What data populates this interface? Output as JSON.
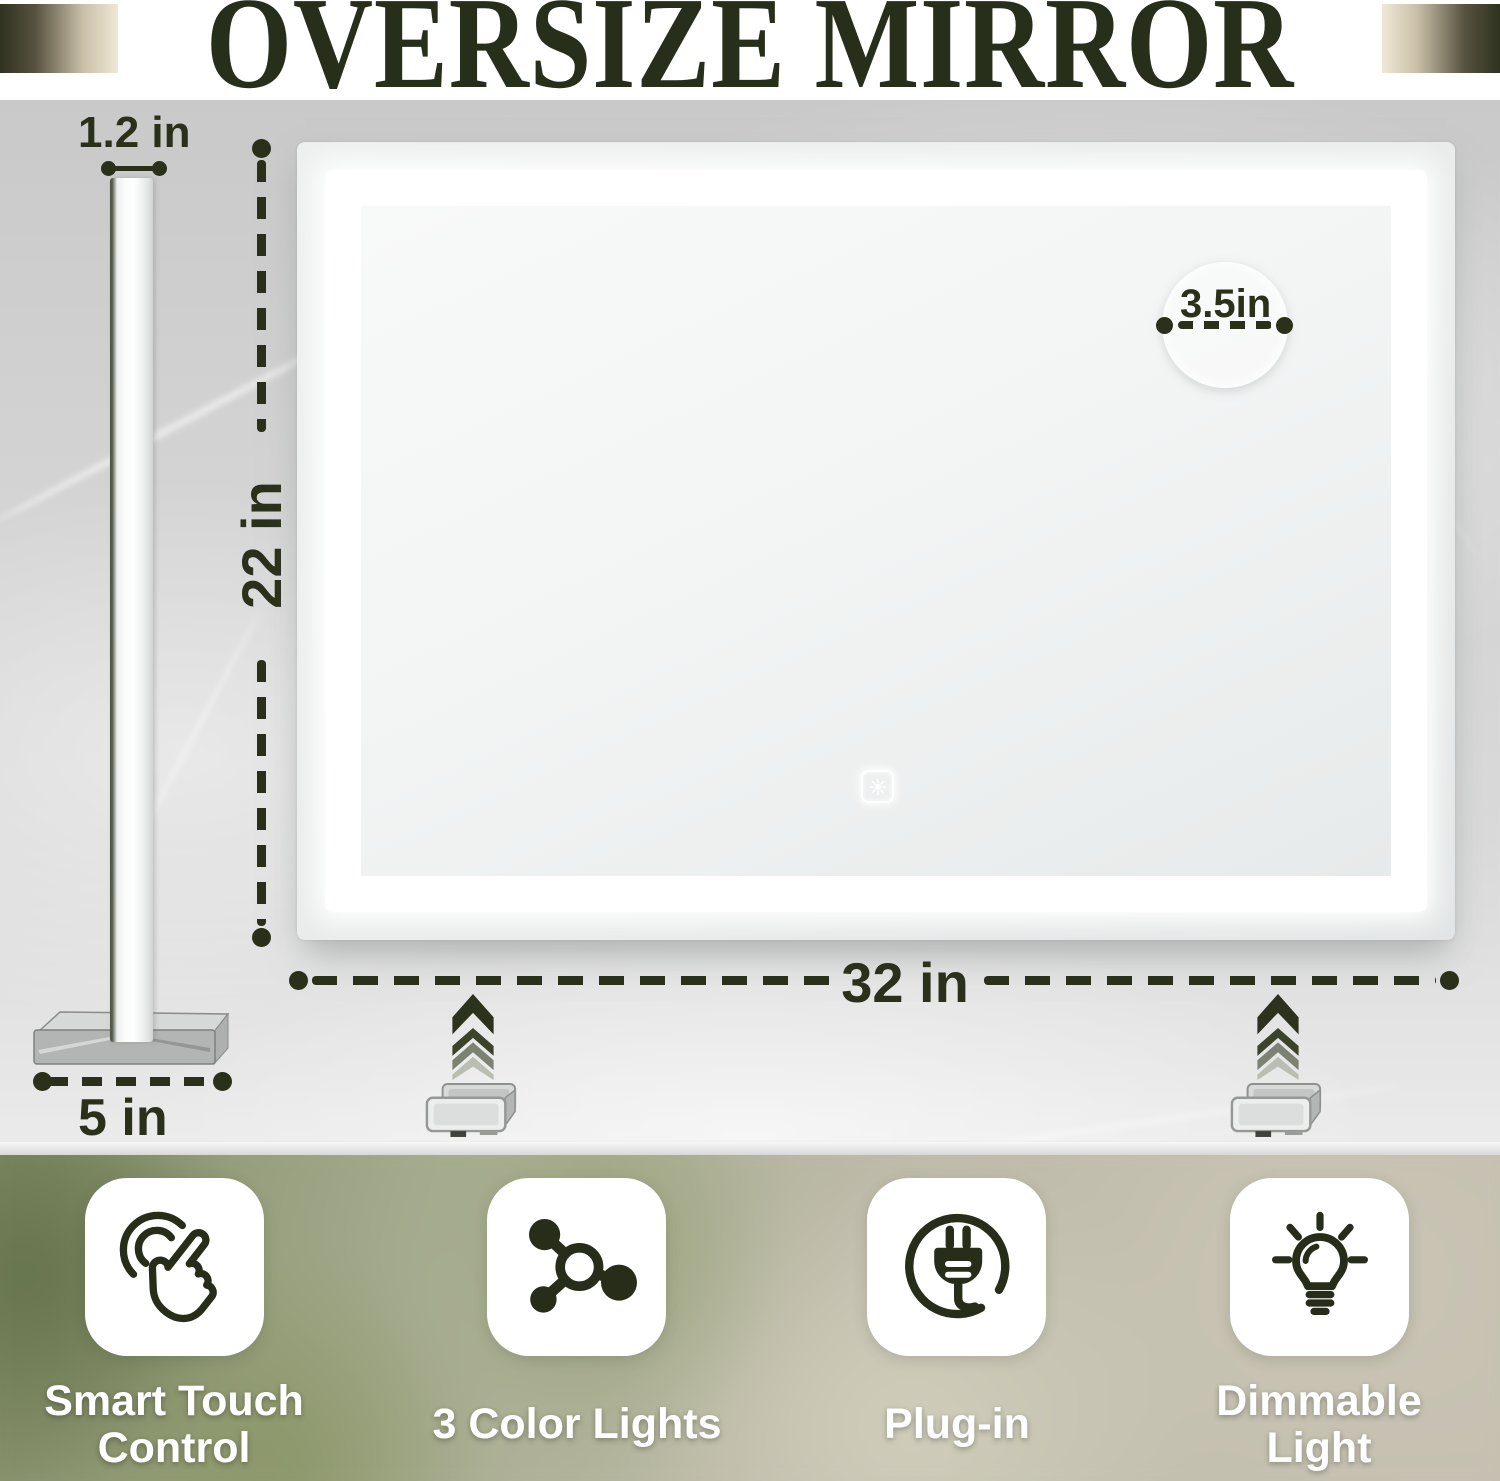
{
  "title": "OVERSIZE MIRROR",
  "side_view": {
    "thickness_label": "1.2 in",
    "base_width_label": "5 in"
  },
  "front_view": {
    "height_label": "22 in",
    "width_label": "32 in",
    "sensor_zone_label": "3.5in"
  },
  "features": [
    {
      "label": "Smart Touch Control",
      "icon": "touch-gesture-icon"
    },
    {
      "label": "3 Color Lights",
      "icon": "molecule-lights-icon"
    },
    {
      "label": "Plug-in",
      "icon": "power-plug-icon"
    },
    {
      "label": "Dimmable Light",
      "icon": "light-bulb-icon"
    }
  ],
  "colors": {
    "accent_dark_olive": "#2a3019",
    "title_color": "#272e1a",
    "led_white": "#ffffff",
    "marble_gray": "#d3d3d3",
    "card_white": "#ffffff"
  }
}
